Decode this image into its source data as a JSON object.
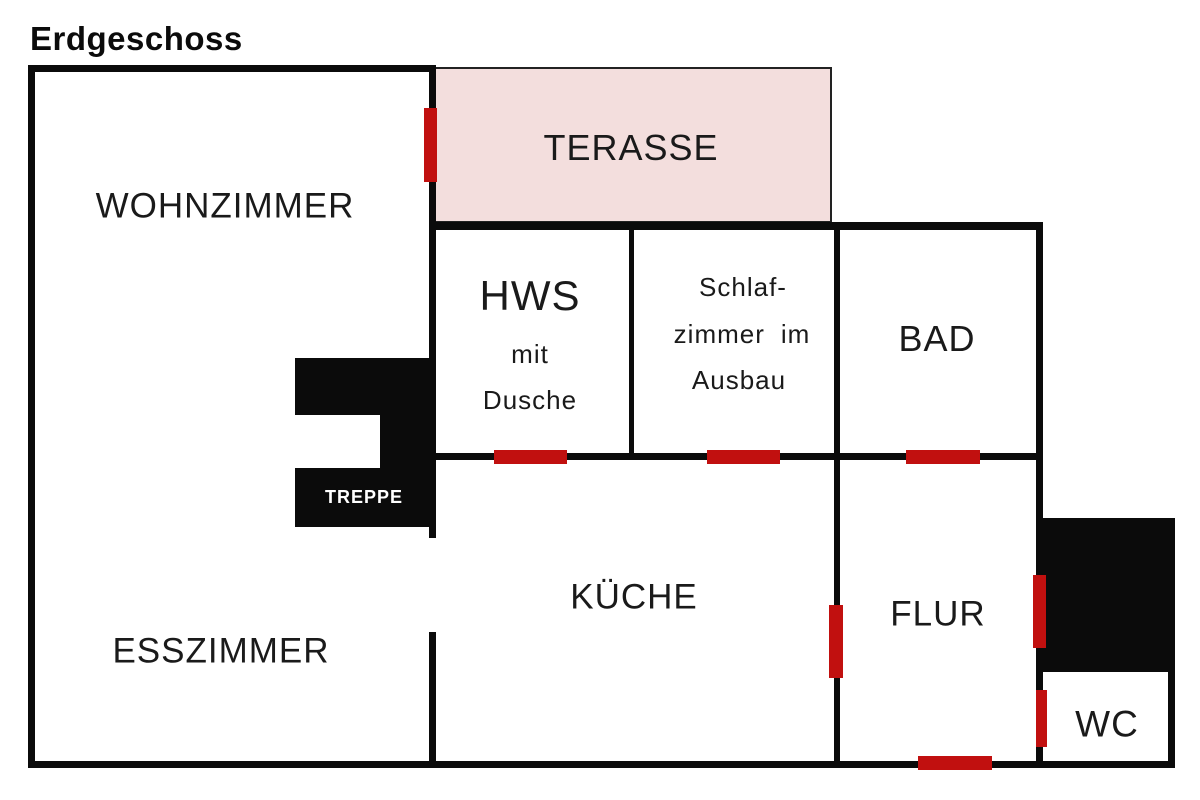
{
  "title": "Erdgeschoss",
  "canvas": {
    "width": 1200,
    "height": 800
  },
  "colors": {
    "background": "#ffffff",
    "wall": "#0b0b0b",
    "door_marker": "#c1100f",
    "terrace_fill": "#f3dedd",
    "terrace_border": "#222222",
    "stair_fill": "#0b0b0b",
    "label_color": "#1a1a1a",
    "stair_label_color": "#ffffff"
  },
  "regions": {
    "terrace": {
      "name": "terrace-area",
      "x": 433,
      "y": 67,
      "w": 399,
      "h": 156
    },
    "stair_blocks": [
      {
        "name": "stair-block-top",
        "x": 295,
        "y": 358,
        "w": 134,
        "h": 57
      },
      {
        "name": "stair-block-right",
        "x": 380,
        "y": 415,
        "w": 49,
        "h": 53
      },
      {
        "name": "stair-block-bottom",
        "x": 295,
        "y": 468,
        "w": 134,
        "h": 59
      },
      {
        "name": "storage-block",
        "x": 1043,
        "y": 518,
        "w": 132,
        "h": 154
      }
    ]
  },
  "walls": [
    {
      "name": "wall-outer-top",
      "x": 28,
      "y": 65,
      "w": 408,
      "h": 7
    },
    {
      "name": "wall-outer-left",
      "x": 28,
      "y": 65,
      "w": 7,
      "h": 703
    },
    {
      "name": "wall-outer-bottom",
      "x": 28,
      "y": 761,
      "w": 1147,
      "h": 7
    },
    {
      "name": "wall-center-upper",
      "x": 429,
      "y": 65,
      "w": 7,
      "h": 473
    },
    {
      "name": "wall-center-lower",
      "x": 429,
      "y": 632,
      "w": 7,
      "h": 136
    },
    {
      "name": "wall-row-top",
      "x": 429,
      "y": 222,
      "w": 614,
      "h": 8
    },
    {
      "name": "wall-row-middle",
      "x": 429,
      "y": 453,
      "w": 614,
      "h": 7
    },
    {
      "name": "wall-hws-schlafzimmer",
      "x": 629,
      "y": 222,
      "w": 5,
      "h": 238
    },
    {
      "name": "wall-schlafzimmer-bad-flur",
      "x": 834,
      "y": 222,
      "w": 6,
      "h": 546
    },
    {
      "name": "wall-outer-right",
      "x": 1036,
      "y": 222,
      "w": 7,
      "h": 546
    },
    {
      "name": "wall-wc-right",
      "x": 1168,
      "y": 672,
      "w": 7,
      "h": 96
    }
  ],
  "doors": [
    {
      "name": "door-wohnzimmer-terrasse",
      "x": 424,
      "y": 108,
      "w": 13,
      "h": 74
    },
    {
      "name": "door-hws",
      "x": 494,
      "y": 450,
      "w": 73,
      "h": 14
    },
    {
      "name": "door-schlafzimmer",
      "x": 707,
      "y": 450,
      "w": 73,
      "h": 14
    },
    {
      "name": "door-bad",
      "x": 906,
      "y": 450,
      "w": 74,
      "h": 14
    },
    {
      "name": "door-kueche-flur",
      "x": 829,
      "y": 605,
      "w": 14,
      "h": 73
    },
    {
      "name": "door-flur-storage",
      "x": 1033,
      "y": 575,
      "w": 13,
      "h": 73
    },
    {
      "name": "door-flur-wc",
      "x": 1036,
      "y": 690,
      "w": 11,
      "h": 57
    },
    {
      "name": "door-entrance",
      "x": 918,
      "y": 756,
      "w": 74,
      "h": 14
    }
  ],
  "labels": [
    {
      "name": "room-label-wohnzimmer",
      "text": "WOHNZIMMER",
      "cx": 225,
      "cy": 206,
      "size": 35
    },
    {
      "name": "room-label-terrasse",
      "text": "TERASSE",
      "cx": 631,
      "cy": 148,
      "size": 36
    },
    {
      "name": "room-label-hws",
      "text": "HWS",
      "cx": 530,
      "cy": 296,
      "size": 42
    },
    {
      "name": "room-label-hws-line2",
      "text": "mit",
      "cx": 530,
      "cy": 354,
      "size": 26
    },
    {
      "name": "room-label-hws-line3",
      "text": "Dusche",
      "cx": 530,
      "cy": 400,
      "size": 26
    },
    {
      "name": "room-label-schlafzimmer-line1",
      "text": "Schlaf-",
      "cx": 743,
      "cy": 287,
      "size": 26
    },
    {
      "name": "room-label-schlafzimmer-line2",
      "text": "zimmer im",
      "cx": 742,
      "cy": 334,
      "size": 26
    },
    {
      "name": "room-label-schlafzimmer-line3",
      "text": "Ausbau",
      "cx": 739,
      "cy": 380,
      "size": 26
    },
    {
      "name": "room-label-bad",
      "text": "BAD",
      "cx": 937,
      "cy": 339,
      "size": 36
    },
    {
      "name": "stair-label",
      "text": "TREPPE",
      "cx": 364,
      "cy": 497,
      "size": 18,
      "bold": true,
      "use_stair_color": true
    },
    {
      "name": "room-label-esszimmer",
      "text": "ESSZIMMER",
      "cx": 221,
      "cy": 651,
      "size": 35
    },
    {
      "name": "room-label-kueche",
      "text": "KÜCHE",
      "cx": 634,
      "cy": 597,
      "size": 35
    },
    {
      "name": "room-label-flur",
      "text": "FLUR",
      "cx": 938,
      "cy": 614,
      "size": 35
    },
    {
      "name": "room-label-wc",
      "text": "WC",
      "cx": 1107,
      "cy": 724,
      "size": 37
    }
  ]
}
